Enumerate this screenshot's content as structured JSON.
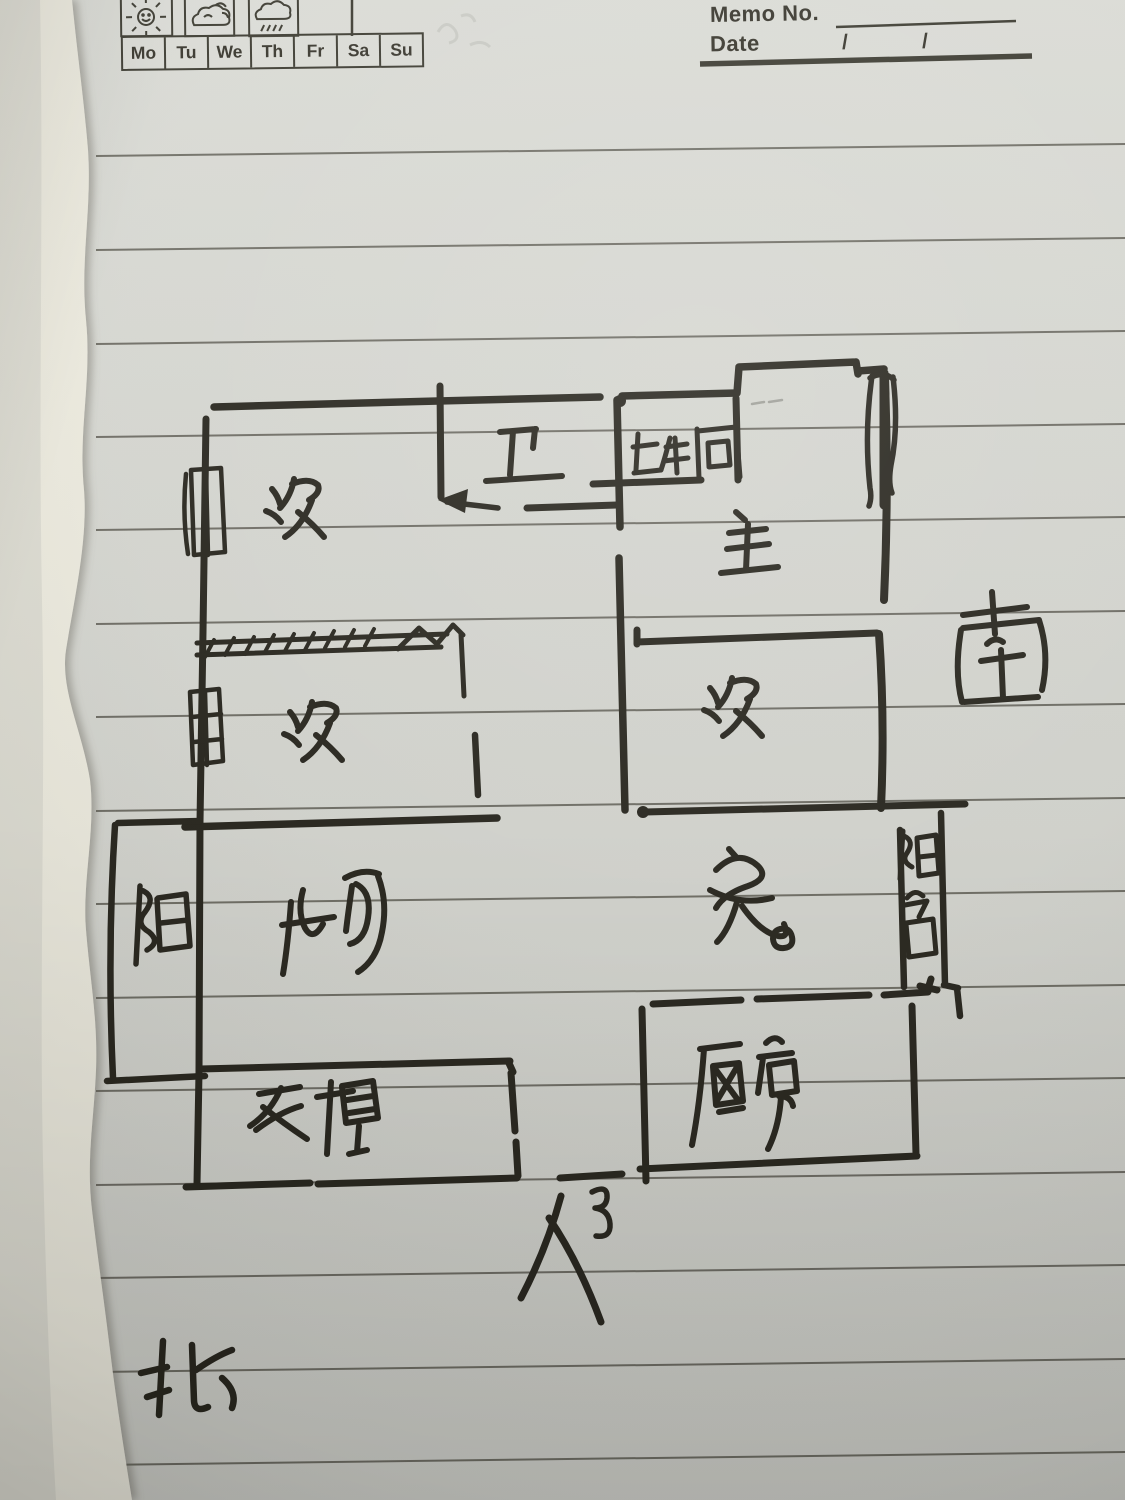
{
  "header": {
    "memo_label": "Memo No.",
    "date_label": "Date",
    "date_slashes": [
      "/",
      "/"
    ],
    "days": [
      "Mo",
      "Tu",
      "We",
      "Th",
      "Fr",
      "Sa",
      "Su"
    ],
    "weather_icons": [
      "sun-face-icon",
      "cloud-sun-icon",
      "rain-cloud-icon"
    ]
  },
  "floorplan": {
    "rooms": [
      {
        "label": "次",
        "position": "top-left-bedroom"
      },
      {
        "label": "卫",
        "position": "top-middle-bathroom"
      },
      {
        "label": "卫生间",
        "position": "top-right-bathroom"
      },
      {
        "label": "主",
        "position": "right-master-bedroom"
      },
      {
        "label": "次",
        "position": "middle-left-bedroom"
      },
      {
        "label": "次",
        "position": "middle-right-bedroom"
      },
      {
        "label": "客厅",
        "position": "center-living-room"
      },
      {
        "label": "餐",
        "position": "center-right-dining"
      },
      {
        "label": "阳",
        "position": "left-balcony"
      },
      {
        "label": "阳台",
        "position": "right-balcony-strip"
      },
      {
        "label": "衣帽",
        "position": "bottom-left-cloakroom"
      },
      {
        "label": "厨房",
        "position": "bottom-right-kitchen"
      }
    ],
    "annotations": [
      {
        "label": "入户",
        "position": "bottom-entrance"
      },
      {
        "label": "南",
        "position": "compass-south-right"
      },
      {
        "label": "北",
        "position": "compass-north-bottom"
      }
    ]
  },
  "colors": {
    "ink": "#29271f",
    "paper": "#d5d6d0",
    "rule_line": "#57554c",
    "torn_edge": "#eeede4"
  }
}
